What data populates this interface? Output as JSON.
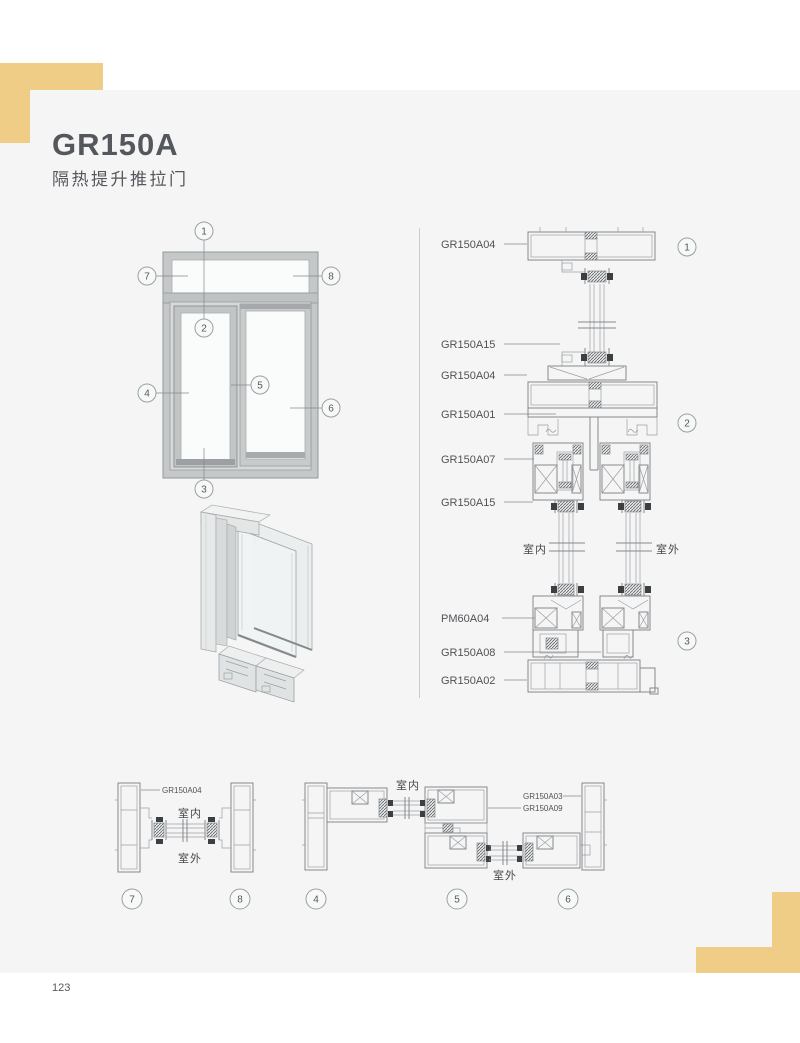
{
  "page": {
    "title": "GR150A",
    "subtitle": "隔热提升推拉门",
    "page_number": "123"
  },
  "colors": {
    "accent": "#f0cd86",
    "panel_background": "#f5f5f6",
    "ink": "#55585c",
    "line": "#8a8e91"
  },
  "elevation": {
    "callouts": [
      "1",
      "2",
      "3",
      "4",
      "5",
      "6",
      "7",
      "8"
    ]
  },
  "vertical_section": {
    "labels": [
      "GR150A04",
      "GR150A15",
      "GR150A04",
      "GR150A01",
      "GR150A07",
      "GR150A15",
      "PM60A04",
      "GR150A08",
      "GR150A02"
    ],
    "indoor": "室内",
    "outdoor": "室外",
    "callouts": [
      "1",
      "2",
      "3"
    ]
  },
  "horizontal_section_frame": {
    "label": "GR150A04",
    "indoor": "室内",
    "outdoor": "室外",
    "callouts": [
      "7",
      "8"
    ]
  },
  "horizontal_section_sash": {
    "labels": [
      "GR150A03",
      "GR150A09"
    ],
    "indoor": "室内",
    "outdoor": "室外",
    "callouts": [
      "4",
      "5",
      "6"
    ]
  }
}
